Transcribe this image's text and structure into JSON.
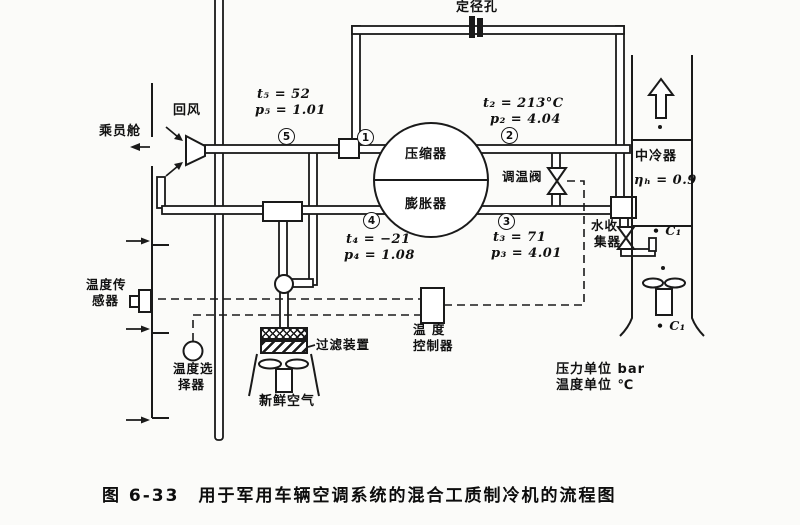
{
  "figure": {
    "caption": "图 6-33　用于军用车辆空调系统的混合工质制冷机的流程图"
  },
  "labels": {
    "cabin": "乘员舱",
    "return_air": "回风",
    "orifice": "定径孔",
    "compressor": "压缩器",
    "expander": "膨胀器",
    "temp_valve": "调温阀",
    "intercooler": "中冷器",
    "water_collector_1": "水收",
    "water_collector_2": "集器",
    "temp_sensor_1": "温度传",
    "temp_sensor_2": "感器",
    "temp_selector_1": "温度选",
    "temp_selector_2": "择器",
    "temp_controller_1": "温 度",
    "temp_controller_2": "控制器",
    "filter": "过滤装置",
    "fresh_air": "新鲜空气",
    "pressure_unit": "压力单位 bar",
    "temperature_unit": "温度单位 ℃",
    "cooling_air_top": "• C₁",
    "cooling_air_bottom": "• C₁"
  },
  "values": {
    "t5": "t₅ = 52",
    "p5": "p₅ = 1.01",
    "t2": "t₂ = 213°C",
    "p2": "p₂ = 4.04",
    "t3": "t₃ = 71",
    "p3": "p₃ = 4.01",
    "t4": "t₄ = −21",
    "p4": "p₄ = 1.08",
    "intercooler_eff": "ηₕ = 0.9"
  },
  "state_points": {
    "s1": "1",
    "s2": "2",
    "s3": "3",
    "s4": "4",
    "s5": "5"
  },
  "colors": {
    "ink": "#1a1a1a",
    "paper": "#fbfbf9"
  }
}
